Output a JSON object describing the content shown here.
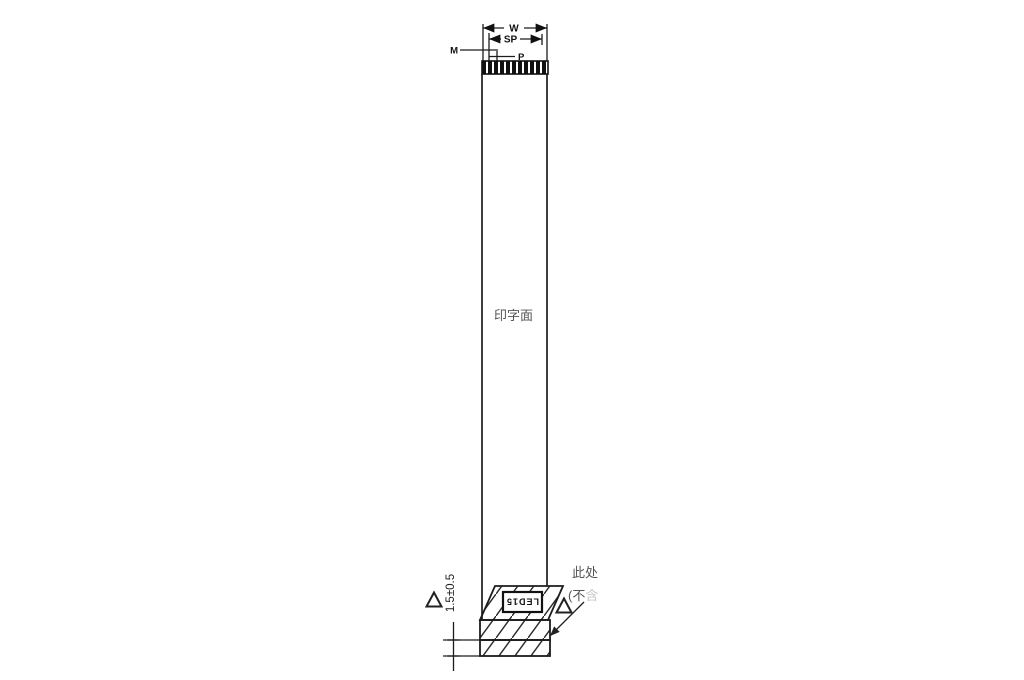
{
  "drawing": {
    "dimensions": {
      "width_label": "W",
      "span_label": "SP",
      "margin_label": "M",
      "pitch_label": "P",
      "end_thickness": "1.5±0.5"
    },
    "cable": {
      "conductor_count": 11,
      "printed_side_label": "印字面"
    },
    "stiffener": {
      "marking": "LED15"
    },
    "note": {
      "line1": "此处",
      "line2": "(不",
      "line2_partial": "含"
    },
    "colors": {
      "line": "#222222",
      "text_gray": "#555555",
      "background": "#ffffff"
    }
  }
}
